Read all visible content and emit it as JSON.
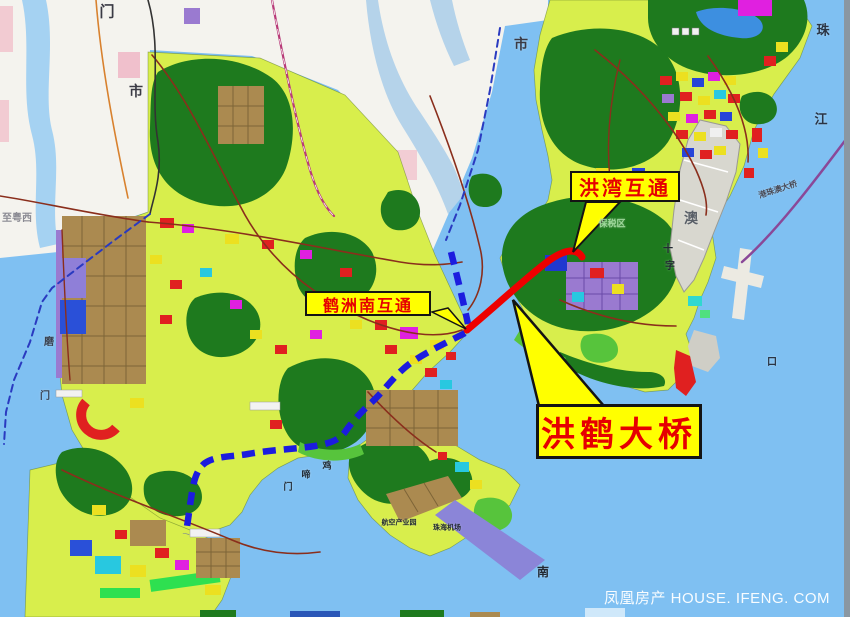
{
  "map": {
    "callouts": {
      "hongwan": {
        "label": "洪湾互通"
      },
      "hezhounan": {
        "label": "鹤洲南互通"
      },
      "bridge": {
        "label": "洪鹤大桥"
      }
    },
    "place_labels": [
      {
        "text": "门",
        "x": 107,
        "y": 12,
        "size": 15,
        "color": "#3a3a44"
      },
      {
        "text": "市",
        "x": 136,
        "y": 91,
        "size": 14,
        "color": "#3a3a44"
      },
      {
        "text": "市",
        "x": 521,
        "y": 44,
        "size": 14,
        "color": "#3a3a44"
      },
      {
        "text": "珠",
        "x": 823,
        "y": 30,
        "size": 13,
        "color": "#2a3444"
      },
      {
        "text": "江",
        "x": 821,
        "y": 119,
        "size": 13,
        "color": "#2a3444"
      },
      {
        "text": "澳",
        "x": 691,
        "y": 218,
        "size": 14,
        "color": "#5a6068"
      },
      {
        "text": "十",
        "x": 668,
        "y": 250,
        "size": 10,
        "color": "#222a33"
      },
      {
        "text": "字",
        "x": 670,
        "y": 267,
        "size": 10,
        "color": "#222a33"
      },
      {
        "text": "口",
        "x": 772,
        "y": 363,
        "size": 10,
        "color": "#2a3444"
      },
      {
        "text": "至粤西",
        "x": 17,
        "y": 219,
        "size": 10,
        "color": "#8a8a92"
      },
      {
        "text": "磨",
        "x": 49,
        "y": 343,
        "size": 10,
        "color": "#3a4250"
      },
      {
        "text": "门",
        "x": 45,
        "y": 397,
        "size": 10,
        "color": "#3a4250"
      },
      {
        "text": "鸡",
        "x": 327,
        "y": 466,
        "size": 9,
        "color": "#222a33"
      },
      {
        "text": "啼",
        "x": 306,
        "y": 475,
        "size": 9,
        "color": "#222a33"
      },
      {
        "text": "门",
        "x": 288,
        "y": 487,
        "size": 9,
        "color": "#222a33"
      },
      {
        "text": "南",
        "x": 543,
        "y": 572,
        "size": 12,
        "color": "#222a33"
      },
      {
        "text": "航空产业园",
        "x": 399,
        "y": 523,
        "size": 7,
        "color": "#222a33"
      },
      {
        "text": "珠海机场",
        "x": 447,
        "y": 528,
        "size": 7,
        "color": "#222a33"
      },
      {
        "text": "保税区",
        "x": 612,
        "y": 224,
        "size": 9,
        "color": "#9fd89b"
      },
      {
        "text": "港珠澳大桥",
        "x": 778,
        "y": 190,
        "size": 8,
        "color": "#4a4a55",
        "rot": -18
      }
    ],
    "watermark": {
      "text": "凤凰房产 HOUSE. IFENG. COM"
    },
    "colors": {
      "water": "#7fc0f2",
      "land": "#d8ee4c",
      "forest": "#1e7a1e",
      "route_built": "#ee0000",
      "route_planned": "#1c1cdf",
      "callout_bg": "#ffff00",
      "callout_border": "#141414",
      "callout_text": "#e60000"
    }
  }
}
